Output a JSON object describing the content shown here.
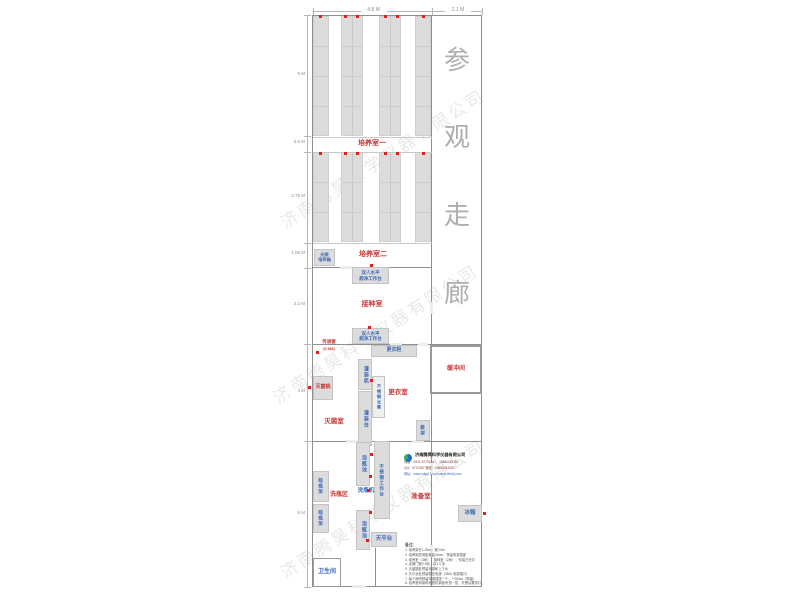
{
  "watermark_text": "济南腾昊科学仪器有限公司",
  "corridor": {
    "label": "参观走廊",
    "chars": [
      {
        "ch": "参",
        "x": 444,
        "y": 48
      },
      {
        "ch": "观",
        "x": 444,
        "y": 125
      },
      {
        "ch": "走",
        "x": 444,
        "y": 203
      },
      {
        "ch": "廊",
        "x": 444,
        "y": 281
      }
    ]
  },
  "colors": {
    "room_label_red": "#c93a36",
    "equipment_label_blue": "#3a67b8",
    "marker_dot_red": "#e02020",
    "rack_fill_gray": "#dcdcdc",
    "wall_gray": "#8f8f8f"
  },
  "dimensions": {
    "top": [
      {
        "label": "4.8 M",
        "x1": 313,
        "x2": 432
      },
      {
        "label": "2.1 M",
        "x1": 432,
        "x2": 482
      }
    ],
    "left": [
      {
        "label": "5 M",
        "y": 75
      },
      {
        "label": "0.6 M",
        "y": 143
      },
      {
        "label": "3.75 M",
        "y": 197
      },
      {
        "label": "1.05 M",
        "y": 254
      },
      {
        "label": "3.2 M",
        "y": 305
      },
      {
        "label": "4 M",
        "y": 392
      },
      {
        "label": "6 M",
        "y": 514
      }
    ],
    "left_ticks": [
      15,
      136,
      152,
      243,
      268,
      344,
      441,
      587
    ]
  },
  "walls": [
    {
      "x": 312,
      "y": 15,
      "w": 170,
      "h": 1
    },
    {
      "x": 312,
      "y": 586,
      "w": 170,
      "h": 1
    },
    {
      "x": 312,
      "y": 15,
      "w": 1,
      "h": 572
    },
    {
      "x": 481,
      "y": 15,
      "w": 1,
      "h": 572
    },
    {
      "x": 431,
      "y": 15,
      "w": 1,
      "h": 572
    },
    {
      "x": 313,
      "y": 137,
      "w": 119,
      "h": 1,
      "light": true
    },
    {
      "x": 313,
      "y": 152,
      "w": 119,
      "h": 1,
      "light": true
    },
    {
      "x": 313,
      "y": 243,
      "w": 119,
      "h": 1,
      "light": true
    },
    {
      "x": 313,
      "y": 267,
      "w": 119,
      "h": 1
    },
    {
      "x": 313,
      "y": 344,
      "w": 169,
      "h": 1
    },
    {
      "x": 313,
      "y": 441,
      "w": 169,
      "h": 1
    },
    {
      "x": 375,
      "y": 548,
      "w": 1,
      "h": 39
    }
  ],
  "boxes": [
    {
      "name": "buffer-room-box",
      "x": 430,
      "y": 345,
      "w": 52,
      "h": 49,
      "border": 2
    },
    {
      "name": "bathroom-box",
      "x": 313,
      "y": 558,
      "w": 28,
      "h": 29,
      "border": 1
    }
  ],
  "doors": [
    {
      "x": 390,
      "y": 343,
      "w": 12,
      "h": 3
    },
    {
      "x": 418,
      "y": 343,
      "w": 10,
      "h": 3
    },
    {
      "x": 346,
      "y": 440,
      "w": 12,
      "h": 3
    },
    {
      "x": 412,
      "y": 440,
      "w": 12,
      "h": 3
    },
    {
      "x": 340,
      "y": 266,
      "w": 12,
      "h": 3
    },
    {
      "x": 352,
      "y": 585,
      "w": 14,
      "h": 3
    },
    {
      "x": 430,
      "y": 302,
      "w": 3,
      "h": 12
    },
    {
      "x": 430,
      "y": 462,
      "w": 3,
      "h": 12
    },
    {
      "x": 430,
      "y": 545,
      "w": 3,
      "h": 12
    }
  ],
  "racks": {
    "columns": [
      {
        "x": 313,
        "w": 16,
        "seam": false
      },
      {
        "x": 341,
        "w": 22,
        "seam": true
      },
      {
        "x": 379,
        "w": 22,
        "seam": true
      },
      {
        "x": 415,
        "w": 16,
        "seam": false
      }
    ],
    "sections": [
      {
        "y": 16,
        "h": 120
      },
      {
        "y": 152,
        "h": 90
      }
    ]
  },
  "room_labels": [
    {
      "text": "培养室一",
      "x": 372,
      "y": 144,
      "size": 7,
      "color": "red"
    },
    {
      "text": "培养室二",
      "x": 373,
      "y": 255,
      "size": 7,
      "color": "red"
    },
    {
      "text": "接种室",
      "x": 372,
      "y": 305,
      "size": 7,
      "color": "red"
    },
    {
      "text": "更衣室",
      "x": 398,
      "y": 394,
      "size": 6.5,
      "color": "red"
    },
    {
      "text": "灭菌室",
      "x": 334,
      "y": 423,
      "size": 6.5,
      "color": "red"
    },
    {
      "text": "洗瓶区",
      "x": 339,
      "y": 495,
      "size": 6,
      "color": "red"
    },
    {
      "text": "准备室",
      "x": 421,
      "y": 498,
      "size": 6.5,
      "color": "red"
    },
    {
      "text": "缓冲间",
      "x": 456,
      "y": 369,
      "size": 6,
      "color": "red"
    },
    {
      "text": "传递窗",
      "x": 329,
      "y": 342,
      "size": 4.5,
      "color": "red"
    },
    {
      "text": "(0.6M)",
      "x": 329,
      "y": 349,
      "size": 4,
      "color": "red"
    },
    {
      "text": "洗瓶机",
      "x": 366,
      "y": 492,
      "size": 5.5,
      "color": "blue"
    },
    {
      "text": "卫生间",
      "x": 327,
      "y": 572,
      "size": 6,
      "color": "blue"
    }
  ],
  "equipment": [
    {
      "text": "光照\n培养箱",
      "x": 314,
      "y": 249,
      "w": 21,
      "h": 17,
      "vert": false,
      "size": 4.2
    },
    {
      "text": "双人水平\n超净工作台",
      "x": 352,
      "y": 267,
      "w": 37,
      "h": 17,
      "vert": false,
      "size": 4.5
    },
    {
      "text": "双人水平\n超净工作台",
      "x": 352,
      "y": 328,
      "w": 37,
      "h": 16,
      "vert": false,
      "size": 4.5
    },
    {
      "text": "更衣柜",
      "x": 371,
      "y": 345,
      "w": 46,
      "h": 12,
      "vert": false,
      "size": 5
    },
    {
      "text": "灌装机",
      "x": 358,
      "y": 359,
      "w": 14,
      "h": 31,
      "vert": true,
      "size": 5
    },
    {
      "text": "不锈钢长凳",
      "x": 372,
      "y": 376,
      "w": 13,
      "h": 42,
      "vert": true,
      "size": 4.2,
      "fill": "#efefef"
    },
    {
      "text": "灌装台",
      "x": 358,
      "y": 391,
      "w": 14,
      "h": 55,
      "vert": true,
      "size": 5
    },
    {
      "text": "灭菌锅",
      "x": 313,
      "y": 376,
      "w": 20,
      "h": 24,
      "vert": false,
      "size": 5,
      "color": "red"
    },
    {
      "text": "鞋架",
      "x": 416,
      "y": 420,
      "w": 14,
      "h": 21,
      "vert": true,
      "size": 4.5
    },
    {
      "text": "泡瓶池",
      "x": 356,
      "y": 442,
      "w": 14,
      "h": 44,
      "vert": true,
      "size": 5
    },
    {
      "text": "不锈钢工作台",
      "x": 374,
      "y": 441,
      "w": 16,
      "h": 78,
      "vert": true,
      "size": 4.5
    },
    {
      "text": "泡瓶池",
      "x": 356,
      "y": 510,
      "w": 14,
      "h": 40,
      "vert": true,
      "size": 5
    },
    {
      "text": "天平台",
      "x": 371,
      "y": 532,
      "w": 26,
      "h": 15,
      "vert": false,
      "size": 5.5
    },
    {
      "text": "晾瓶架",
      "x": 313,
      "y": 471,
      "w": 16,
      "h": 31,
      "vert": true,
      "size": 4.5
    },
    {
      "text": "晾瓶架",
      "x": 313,
      "y": 504,
      "w": 16,
      "h": 29,
      "vert": true,
      "size": 4.5
    },
    {
      "text": "冰箱",
      "x": 458,
      "y": 505,
      "w": 24,
      "h": 17,
      "vert": false,
      "size": 5.5
    }
  ],
  "dots": [
    [
      320,
      16
    ],
    [
      345,
      16
    ],
    [
      357,
      16
    ],
    [
      385,
      16
    ],
    [
      397,
      16
    ],
    [
      423,
      16
    ],
    [
      320,
      153
    ],
    [
      345,
      153
    ],
    [
      357,
      153
    ],
    [
      385,
      153
    ],
    [
      397,
      153
    ],
    [
      423,
      153
    ],
    [
      371,
      265
    ],
    [
      369,
      327
    ],
    [
      317,
      352
    ],
    [
      309,
      387
    ],
    [
      371,
      380
    ],
    [
      371,
      454
    ],
    [
      370,
      476
    ],
    [
      368,
      490
    ],
    [
      370,
      512
    ],
    [
      367,
      540
    ],
    [
      484,
      513
    ]
  ],
  "watermarks": [
    {
      "x": 262,
      "y": 145
    },
    {
      "x": 255,
      "y": 320
    },
    {
      "x": 262,
      "y": 495
    }
  ],
  "company": {
    "name": "济南腾昊科学仪器有限公司",
    "line1": "电话：0531-87794467，15866043352",
    "line2": "QQ：5747487  微信：15866043352",
    "line3": "网址：www.sdyq17.com  www.cnhbj.com"
  },
  "notes": {
    "header": "备注：",
    "items": [
      "培养架长1.25m，宽0.5m",
      "培养架层间距离高40cm，预留电源插座",
      "培养室（3间），接种室（2间），安装日光灯",
      "走廊门宽0.9米，高1.0 米",
      "灭菌锅处预留电源和上下水",
      "天平台处预留稳压电源（380v 电源插口）",
      "每个房间预留电源插座一个，+750kw（预留）",
      "培养室和接种室做彩钢板吊顶一层，天黑后要亮灯。"
    ]
  }
}
